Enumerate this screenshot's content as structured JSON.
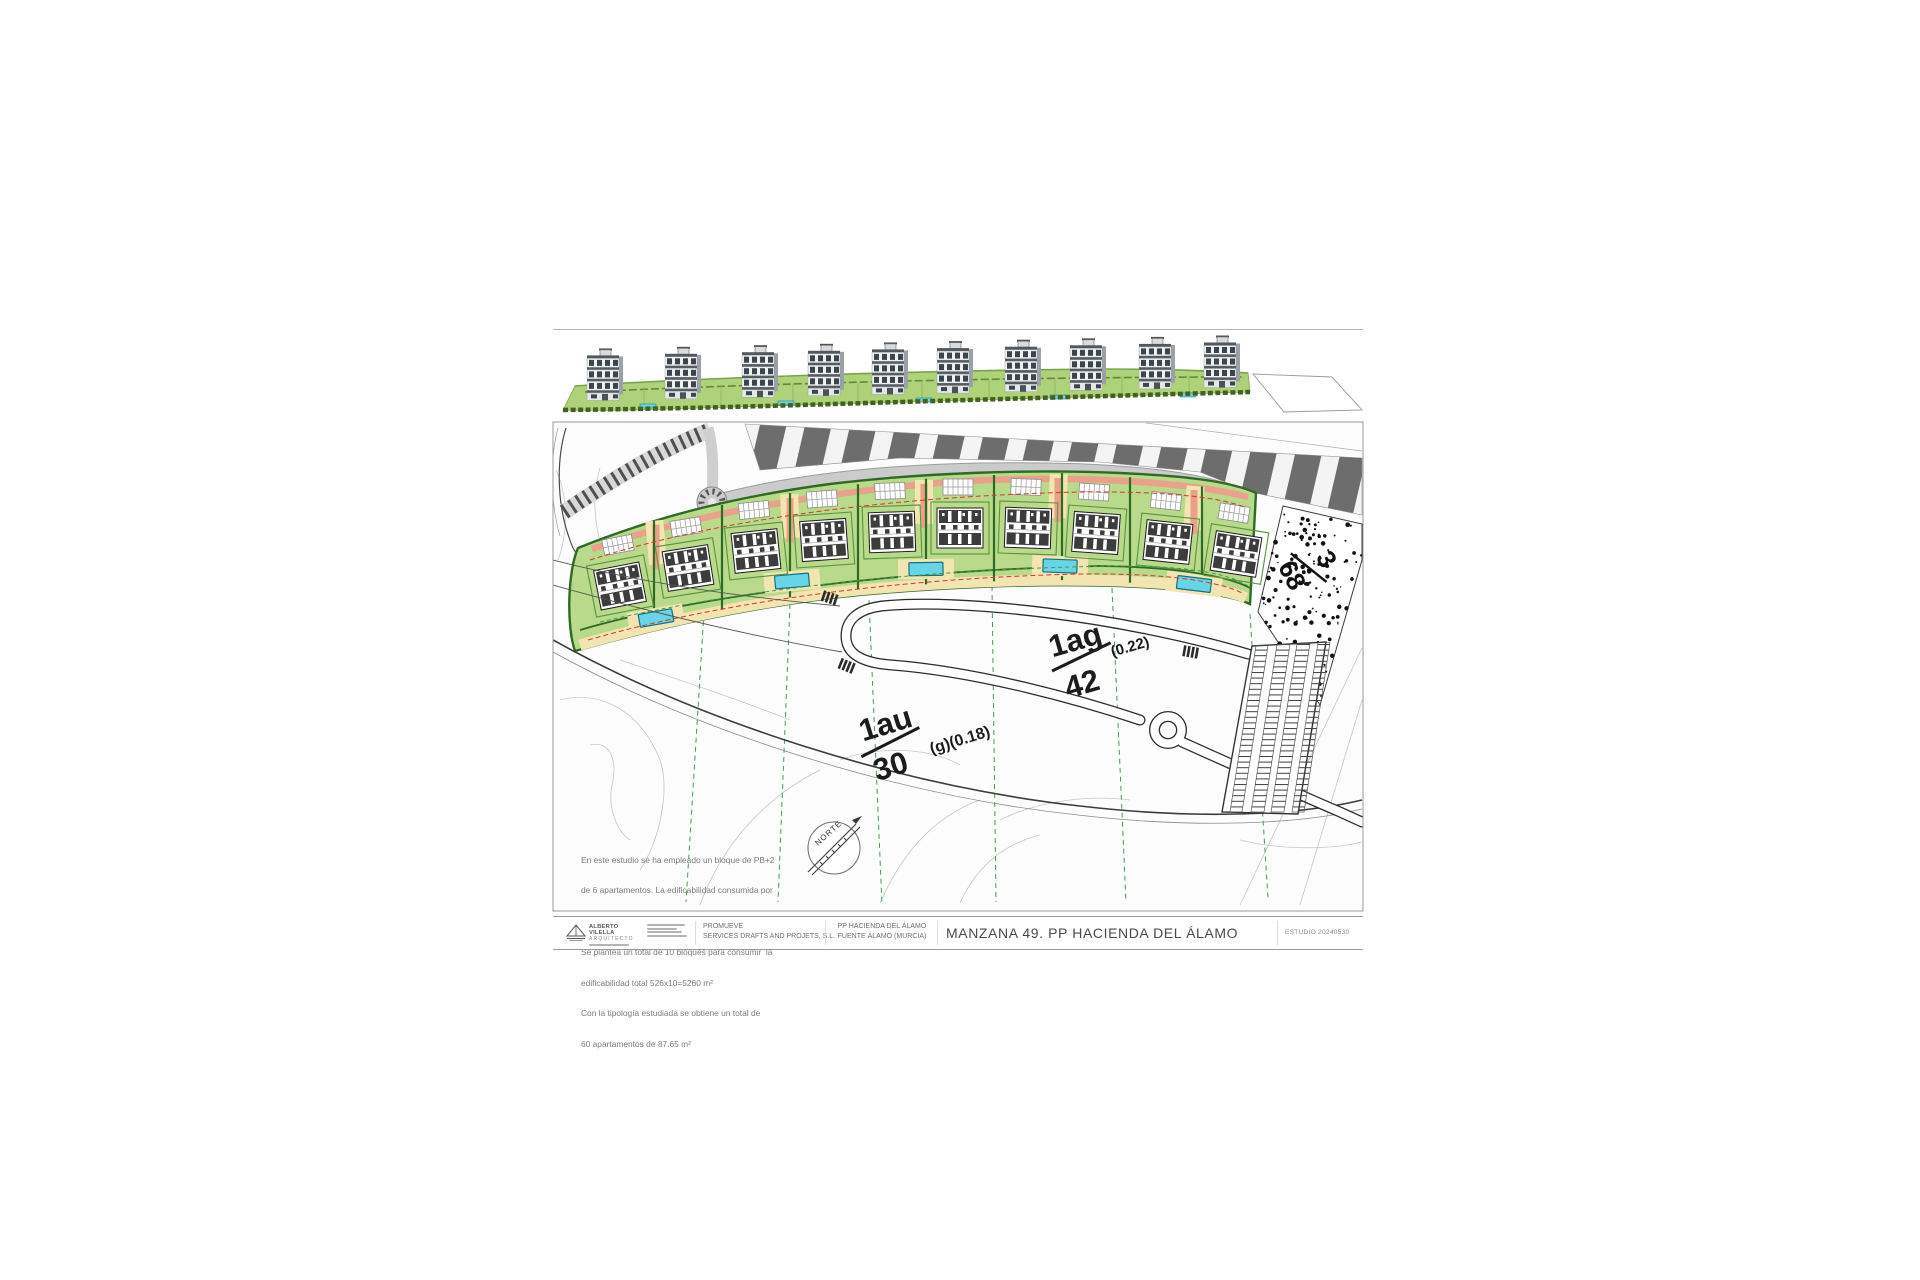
{
  "colors": {
    "plot_green": "#b9d98b",
    "band_green": "#aed279",
    "hedge_green": "#2e6b24",
    "hedge_mid": "#5a9440",
    "hedge_front": "#44611f",
    "path_yellow": "#f2e5b2",
    "path_salmon": "#e9a18b",
    "line_red": "#d23a2a",
    "road_red_edge": "#d45b4a",
    "pool_fill": "#67d4e8",
    "pool_border": "#17707c",
    "road_gray": "#cbcbcb",
    "stripe_dark": "#6d6d6d",
    "contour_gray": "#c6c6c6",
    "dash_green": "#3f9e4e",
    "ink": "#2c2c2c",
    "window_dark": "#39464f",
    "building_slab": "#565c62"
  },
  "elevation": {
    "building_count": 10
  },
  "plan": {
    "building_count": 10,
    "labels": {
      "ag": {
        "num": "1ag",
        "coef": "(0.22)",
        "den": "42"
      },
      "au": {
        "num": "1au",
        "coef": "(g)(0.18)",
        "den": "30"
      },
      "parcel": {
        "num": "3",
        "den": "68"
      },
      "north": "NORTE"
    },
    "notes": [
      "En este estudio se ha empleado un bloque de PB+2",
      "de 6 apartamentos. La edificabilidad consumida por",
      "cada bloque es de 526 m²",
      "Se plantea un total de 10 bloques para consumir  la",
      "edificabilidad total 526x10=5260 m²",
      "Con la tipología estudiada se obtiene un total de",
      "60 apartamentos de 87.65 m²"
    ]
  },
  "title_block": {
    "architect_name": "ALBERTO VILELLA",
    "architect_role": "ARQUITECTO",
    "promoter_label": "PROMUEVE",
    "promoter_name": "SERVICES DRAFTS AND PROJETS, S.L.",
    "project_line1": "PP HACIENDA DEL ÁLAMO",
    "project_line2": "FUENTE ÁLAMO (MURCIA)",
    "sheet_title": "MANZANA 49. PP HACIENDA DEL ÁLAMO",
    "reference": "ESTUDIO 20240530"
  }
}
